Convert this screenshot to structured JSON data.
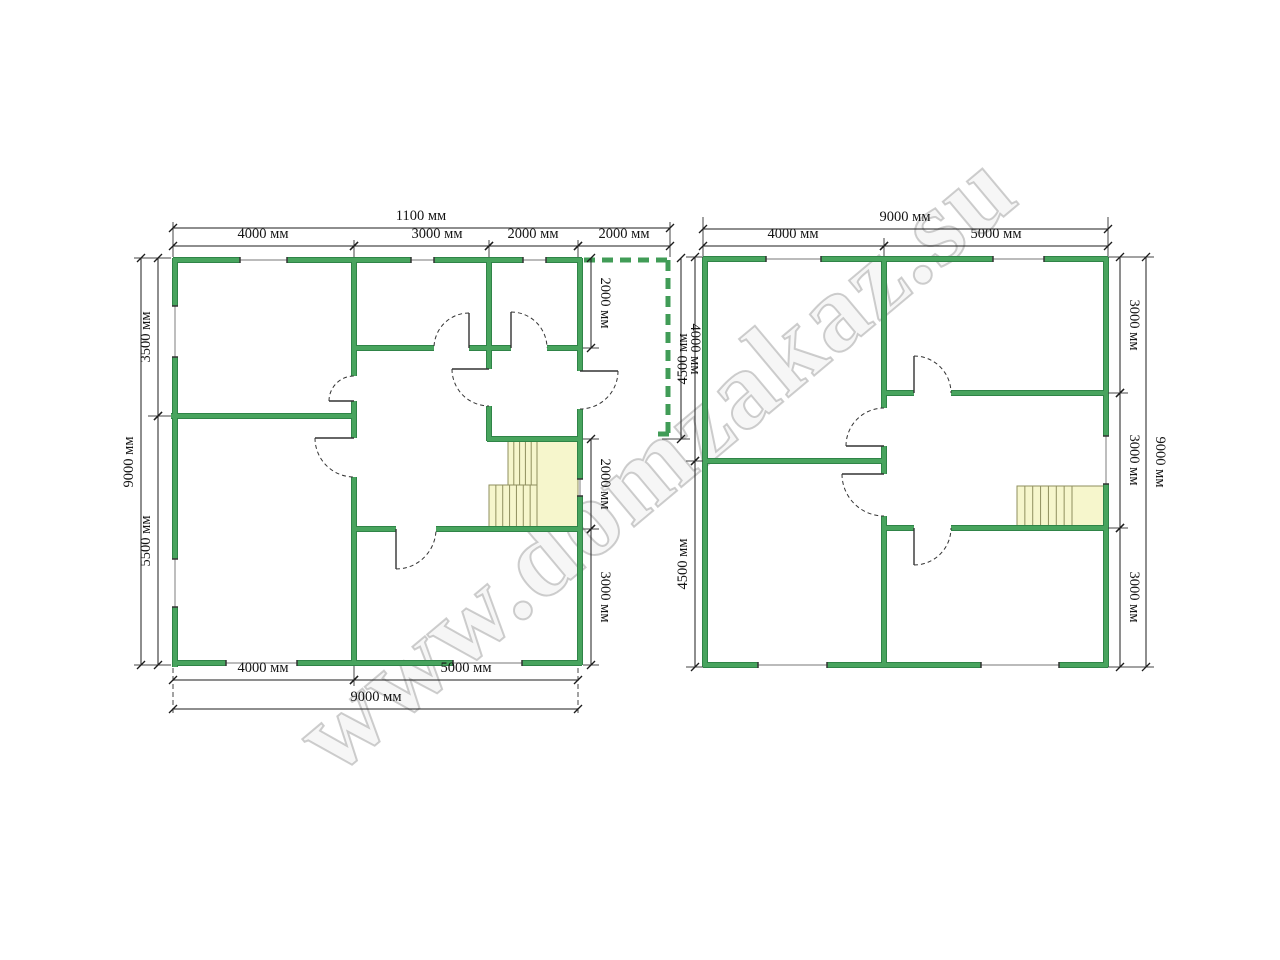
{
  "watermark": {
    "text": "www.domzakaz.su"
  },
  "diagram": {
    "colors": {
      "wall": "#48a45e",
      "wall_edge": "#2f8447",
      "dash": "#419c57",
      "stair_fill": "#f6f6cc",
      "stair_edge": "#8f8f5e",
      "dim": "#1c1c1c",
      "window": "#929292",
      "door": "#333333"
    },
    "walls": [
      [
        173,
        260,
        240,
        260
      ],
      [
        287,
        260,
        411,
        260
      ],
      [
        434,
        260,
        523,
        260
      ],
      [
        546,
        260,
        582,
        260
      ],
      [
        175,
        258,
        175,
        306
      ],
      [
        175,
        357,
        175,
        559
      ],
      [
        175,
        607,
        175,
        667
      ],
      [
        173,
        663,
        226,
        663
      ],
      [
        297,
        663,
        453,
        663
      ],
      [
        522,
        663,
        582,
        663
      ],
      [
        580,
        258,
        580,
        371
      ],
      [
        580,
        409,
        580,
        479
      ],
      [
        580,
        496,
        580,
        665
      ],
      [
        354,
        258,
        354,
        376
      ],
      [
        354,
        401,
        354,
        438
      ],
      [
        354,
        477,
        354,
        665
      ],
      [
        171,
        416,
        356,
        416
      ],
      [
        352,
        348,
        434,
        348
      ],
      [
        469,
        348,
        511,
        348
      ],
      [
        547,
        348,
        582,
        348
      ],
      [
        489,
        258,
        489,
        369
      ],
      [
        489,
        406,
        489,
        441
      ],
      [
        487,
        439,
        582,
        439
      ],
      [
        352,
        529,
        396,
        529
      ],
      [
        436,
        529,
        582,
        529
      ],
      [
        703,
        259,
        766,
        259
      ],
      [
        821,
        259,
        993,
        259
      ],
      [
        1044,
        259,
        1108,
        259
      ],
      [
        705,
        257,
        705,
        667
      ],
      [
        703,
        665,
        758,
        665
      ],
      [
        827,
        665,
        981,
        665
      ],
      [
        1059,
        665,
        1108,
        665
      ],
      [
        1106,
        257,
        1106,
        436
      ],
      [
        1106,
        484,
        1106,
        667
      ],
      [
        884,
        259,
        884,
        408
      ],
      [
        884,
        446,
        884,
        474
      ],
      [
        884,
        516,
        884,
        665
      ],
      [
        703,
        461,
        886,
        461
      ],
      [
        882,
        393,
        914,
        393
      ],
      [
        951,
        393,
        1106,
        393
      ],
      [
        882,
        528,
        914,
        528
      ],
      [
        951,
        528,
        1106,
        528
      ]
    ],
    "terrace": [
      [
        584,
        260,
        668,
        260
      ],
      [
        668,
        260,
        668,
        434
      ],
      [
        658,
        434,
        671,
        434
      ]
    ],
    "windows": [
      [
        240,
        260,
        287,
        260
      ],
      [
        411,
        260,
        434,
        260
      ],
      [
        523,
        260,
        546,
        260
      ],
      [
        226,
        663,
        297,
        663
      ],
      [
        453,
        663,
        522,
        663
      ],
      [
        175,
        306,
        175,
        357
      ],
      [
        175,
        559,
        175,
        607
      ],
      [
        580,
        479,
        580,
        496
      ],
      [
        766,
        259,
        821,
        259
      ],
      [
        993,
        259,
        1044,
        259
      ],
      [
        758,
        665,
        827,
        665
      ],
      [
        981,
        665,
        1059,
        665
      ],
      [
        1106,
        436,
        1106,
        484
      ]
    ],
    "doors": [
      {
        "h": [
          354,
          401
        ],
        "j": [
          354,
          376
        ],
        "side": "ccw"
      },
      {
        "h": [
          354,
          438
        ],
        "j": [
          354,
          477
        ],
        "side": "cw"
      },
      {
        "h": [
          469,
          348
        ],
        "j": [
          434,
          348
        ],
        "side": "cw"
      },
      {
        "h": [
          511,
          348
        ],
        "j": [
          547,
          348
        ],
        "side": "ccw"
      },
      {
        "h": [
          489,
          369
        ],
        "j": [
          489,
          406
        ],
        "side": "cw"
      },
      {
        "h": [
          580,
          371
        ],
        "j": [
          580,
          409
        ],
        "side": "ccw"
      },
      {
        "h": [
          396,
          529
        ],
        "j": [
          436,
          529
        ],
        "side": "cw"
      },
      {
        "h": [
          884,
          446
        ],
        "j": [
          884,
          408
        ],
        "side": "ccw"
      },
      {
        "h": [
          884,
          474
        ],
        "j": [
          884,
          516
        ],
        "side": "cw"
      },
      {
        "h": [
          914,
          393
        ],
        "j": [
          951,
          393
        ],
        "side": "ccw"
      },
      {
        "h": [
          914,
          528
        ],
        "j": [
          951,
          528
        ],
        "side": "cw"
      }
    ],
    "stairs": [
      [
        508,
        441,
        29,
        44,
        4
      ],
      [
        489,
        485,
        48,
        42,
        6
      ],
      [
        537,
        441,
        41,
        86,
        0
      ],
      [
        1017,
        486,
        55,
        41,
        6
      ],
      [
        1072,
        486,
        34,
        41,
        0
      ]
    ],
    "xlines": [
      [
        173,
        257,
        173,
        222,
        0
      ],
      [
        670,
        257,
        670,
        222,
        0
      ],
      [
        354,
        257,
        354,
        240,
        0
      ],
      [
        489,
        257,
        489,
        240,
        0
      ],
      [
        578,
        257,
        578,
        240,
        0
      ],
      [
        134,
        258,
        171,
        258,
        0
      ],
      [
        134,
        665,
        171,
        665,
        0
      ],
      [
        148,
        416,
        171,
        416,
        0
      ],
      [
        583,
        348,
        599,
        348,
        0
      ],
      [
        583,
        439,
        599,
        439,
        0
      ],
      [
        662,
        439,
        690,
        439,
        0
      ],
      [
        583,
        529,
        599,
        529,
        0
      ],
      [
        583,
        665,
        599,
        665,
        0
      ],
      [
        173,
        668,
        173,
        714,
        1
      ],
      [
        578,
        668,
        578,
        714,
        1
      ],
      [
        354,
        666,
        354,
        686,
        0
      ],
      [
        703,
        256,
        703,
        217,
        0
      ],
      [
        1108,
        256,
        1108,
        217,
        0
      ],
      [
        884,
        256,
        884,
        238,
        0
      ],
      [
        686,
        257,
        703,
        257,
        0
      ],
      [
        686,
        461,
        703,
        461,
        0
      ],
      [
        686,
        667,
        703,
        667,
        0
      ],
      [
        1108,
        257,
        1154,
        257,
        0
      ],
      [
        1108,
        393,
        1128,
        393,
        0
      ],
      [
        1108,
        528,
        1128,
        528,
        0
      ],
      [
        1108,
        667,
        1154,
        667,
        0
      ]
    ],
    "dims": [
      {
        "t": "1100 мм",
        "l": [
          173,
          228,
          670,
          228
        ],
        "p": [
          421,
          220
        ],
        "r": 0
      },
      {
        "t": "4000 мм",
        "l": [
          173,
          246,
          354,
          246
        ],
        "p": [
          263,
          238
        ],
        "r": 0
      },
      {
        "t": "3000 мм",
        "l": [
          354,
          246,
          489,
          246
        ],
        "p": [
          437,
          238
        ],
        "r": 0
      },
      {
        "t": "2000 мм",
        "l": [
          489,
          246,
          578,
          246
        ],
        "p": [
          533,
          238
        ],
        "r": 0
      },
      {
        "t": "2000 мм",
        "l": [
          578,
          246,
          670,
          246
        ],
        "p": [
          624,
          238
        ],
        "r": 0
      },
      {
        "t": "9000 мм",
        "l": [
          141,
          258,
          141,
          665
        ],
        "p": [
          133,
          462
        ],
        "r": -90
      },
      {
        "t": "3500 мм",
        "l": [
          158,
          258,
          158,
          416
        ],
        "p": [
          150,
          337
        ],
        "r": -90
      },
      {
        "t": "5500 мм",
        "l": [
          158,
          416,
          158,
          665
        ],
        "p": [
          150,
          541
        ],
        "r": -90
      },
      {
        "t": "2000 мм",
        "l": [
          591,
          258,
          591,
          348
        ],
        "p": [
          601,
          303
        ],
        "r": 90
      },
      {
        "t": "2000 мм",
        "l": [
          591,
          439,
          591,
          529
        ],
        "p": [
          601,
          484
        ],
        "r": 90
      },
      {
        "t": "3000 мм",
        "l": [
          591,
          529,
          591,
          665
        ],
        "p": [
          601,
          597
        ],
        "r": 90
      },
      {
        "t": "4000 мм",
        "l": [
          681,
          258,
          681,
          439
        ],
        "p": [
          691,
          349
        ],
        "r": 90
      },
      {
        "t": "4000 мм",
        "l": [
          173,
          680,
          354,
          680
        ],
        "p": [
          263,
          672
        ],
        "r": 0
      },
      {
        "t": "5000 мм",
        "l": [
          354,
          680,
          578,
          680
        ],
        "p": [
          466,
          672
        ],
        "r": 0
      },
      {
        "t": "9000 мм",
        "l": [
          173,
          709,
          578,
          709
        ],
        "p": [
          376,
          701
        ],
        "r": 0
      },
      {
        "t": "9000 мм",
        "l": [
          703,
          229,
          1108,
          229
        ],
        "p": [
          905,
          221
        ],
        "r": 0
      },
      {
        "t": "4000 мм",
        "l": [
          703,
          246,
          884,
          246
        ],
        "p": [
          793,
          238
        ],
        "r": 0
      },
      {
        "t": "5000 мм",
        "l": [
          884,
          246,
          1108,
          246
        ],
        "p": [
          996,
          238
        ],
        "r": 0
      },
      {
        "t": "4500 мм",
        "l": [
          695,
          257,
          695,
          461
        ],
        "p": [
          687,
          359
        ],
        "r": -90
      },
      {
        "t": "4500 мм",
        "l": [
          695,
          461,
          695,
          667
        ],
        "p": [
          687,
          564
        ],
        "r": -90
      },
      {
        "t": "3000 мм",
        "l": [
          1120,
          257,
          1120,
          393
        ],
        "p": [
          1130,
          325
        ],
        "r": 90
      },
      {
        "t": "3000 мм",
        "l": [
          1120,
          393,
          1120,
          528
        ],
        "p": [
          1130,
          460
        ],
        "r": 90
      },
      {
        "t": "3000 мм",
        "l": [
          1120,
          528,
          1120,
          667
        ],
        "p": [
          1130,
          597
        ],
        "r": 90
      },
      {
        "t": "9000 мм",
        "l": [
          1146,
          257,
          1146,
          667
        ],
        "p": [
          1156,
          462
        ],
        "r": 90
      }
    ]
  }
}
